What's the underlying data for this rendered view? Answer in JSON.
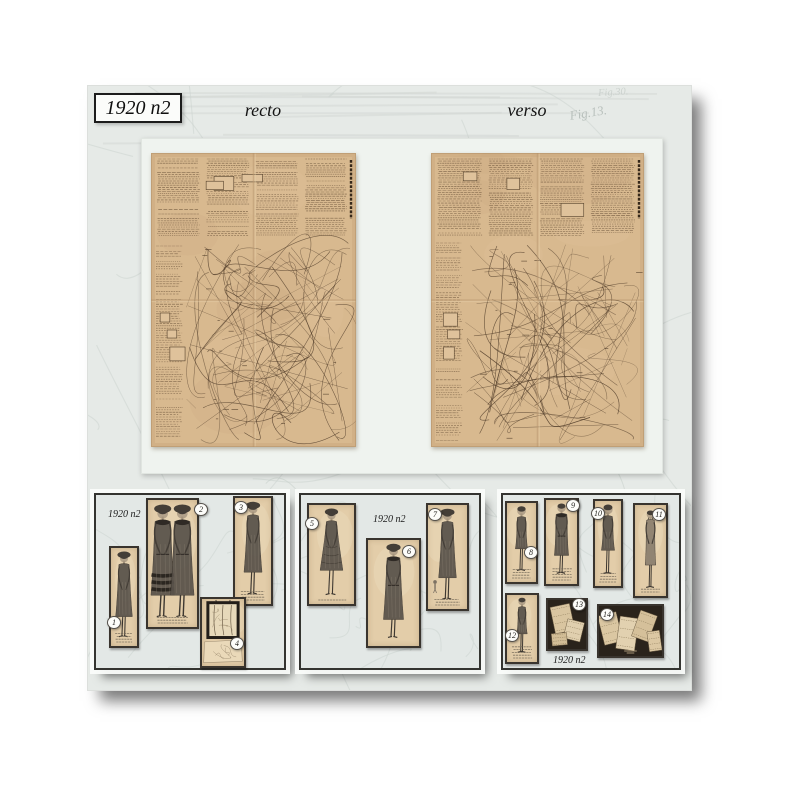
{
  "header": {
    "edition": "1920 n2",
    "recto": "recto",
    "verso": "verso"
  },
  "watermark": {
    "fig_top": "Fig.30.",
    "fig_mid": "Fig.13."
  },
  "panels": [
    {
      "label": "1920 n2",
      "cards": [
        {
          "number": "1"
        },
        {
          "number": "2"
        },
        {
          "number": "3"
        },
        {
          "number": "4"
        }
      ]
    },
    {
      "label": "1920 n2",
      "cards": [
        {
          "number": "5"
        },
        {
          "number": "6"
        },
        {
          "number": "7"
        }
      ]
    },
    {
      "label": "1920 n2",
      "cards": [
        {
          "number": "8"
        },
        {
          "number": "9"
        },
        {
          "number": "10"
        },
        {
          "number": "11"
        },
        {
          "number": "12"
        },
        {
          "number": "13"
        },
        {
          "number": "14"
        }
      ]
    }
  ]
}
